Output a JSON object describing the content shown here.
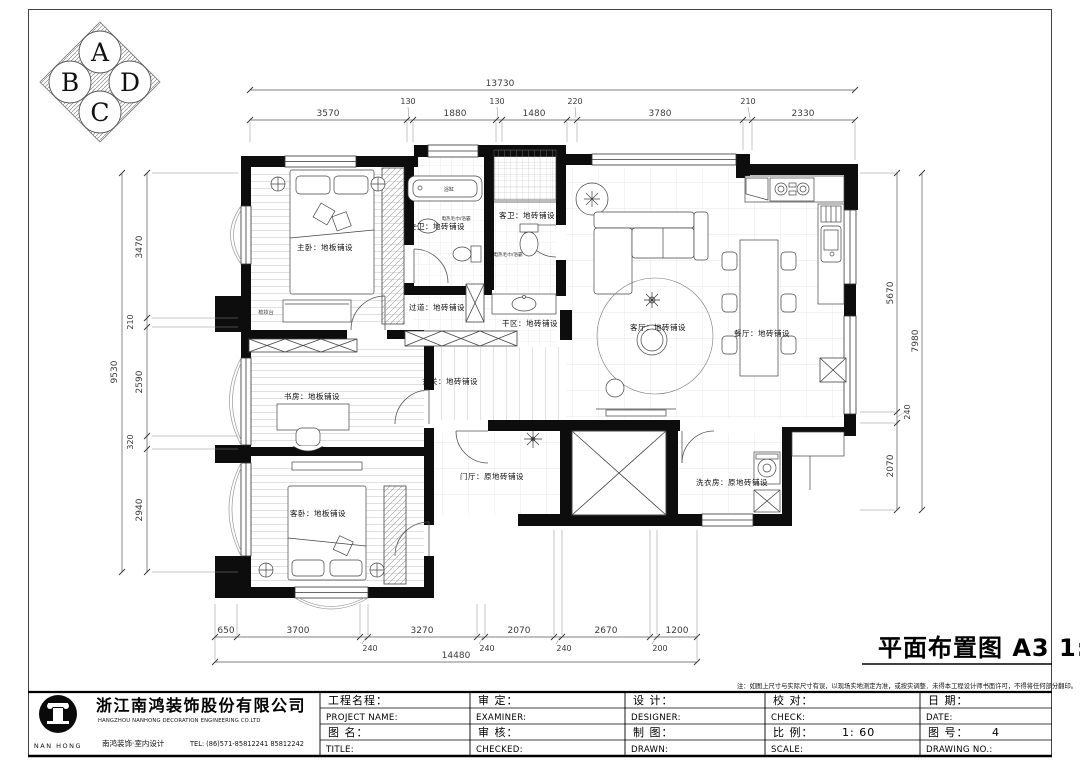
{
  "compass": {
    "a": "A",
    "b": "B",
    "c": "C",
    "d": "D"
  },
  "drawing_title": "平面布置图 A3 1:60",
  "note": "注：如图上尺寸与实际尺寸有误，以现场实地测定为准，或按实调整．未得本工程设计师书面许可，不得将任何部分翻印。",
  "plan": {
    "rooms": {
      "master_bedroom": "主卧：地板铺设",
      "master_bath": "主卫：地砖铺设",
      "guest_bath": "客卫：地砖铺设",
      "corridor": "过道：地砖铺设",
      "dry_area": "干区：地砖铺设",
      "study": "书房：地板铺设",
      "entry": "玄关：地砖铺设",
      "living": "客厅：地砖铺设",
      "dining": "餐厅：地砖铺设",
      "guest_bedroom": "客卧：地板铺设",
      "foyer": "门厅：原地砖铺设",
      "laundry": "洗衣房：原地砖铺设"
    },
    "annotations": {
      "bathtub": "浴缸",
      "dresser": "梳妆台",
      "towel_rack_1": "电热毛巾/浴霸",
      "towel_rack_2": "电热毛巾/浴霸"
    }
  },
  "dims": {
    "top": {
      "overall": "13730",
      "segs": [
        "3570",
        "130",
        "1880",
        "130",
        "1480",
        "220",
        "3780",
        "210",
        "2330"
      ]
    },
    "left": {
      "overall": "9530",
      "segs": [
        "3470",
        "210",
        "2590",
        "320",
        "2940"
      ]
    },
    "right": {
      "overall": "7980",
      "segs": [
        "5670",
        "240",
        "2070"
      ]
    },
    "bottom": {
      "overall": "14480",
      "segs": [
        "650",
        "3700",
        "240",
        "3270",
        "240",
        "2070",
        "240",
        "2670",
        "200",
        "1200"
      ]
    }
  },
  "title_block": {
    "company_cn": "浙江南鸿装饰股份有限公司",
    "company_en": "HANGZHOU NANHONG DECORATION ENGINEERING CO.LTD",
    "brand": "南鸿装饰·室内设计",
    "tel": "TEL: (86)571-85812241  85812242",
    "logo_text": "NAN HONG",
    "fields": {
      "project_cn": "工程名程：",
      "project_en": "PROJECT NAME:",
      "examine_cn": "审  定：",
      "examine_en": "EXAMINER:",
      "design_cn": "设  计：",
      "design_en": "DESIGNER:",
      "title_cn": "图  名：",
      "title_en": "TITLE:",
      "check2_cn": "审  核：",
      "check2_en": "CHECKED:",
      "drawn_cn": "制  图：",
      "drawn_en": "DRAWN:",
      "check_cn": "校  对：",
      "check_en": "CHECK:",
      "date_cn": "日  期：",
      "date_en": "DATE:",
      "scale_cn": "比  例：",
      "scale_value": "1: 60",
      "scale_en": "SCALE:",
      "no_cn": "图  号：",
      "no_value": "4",
      "no_en": "DRAWING NO.:"
    }
  }
}
